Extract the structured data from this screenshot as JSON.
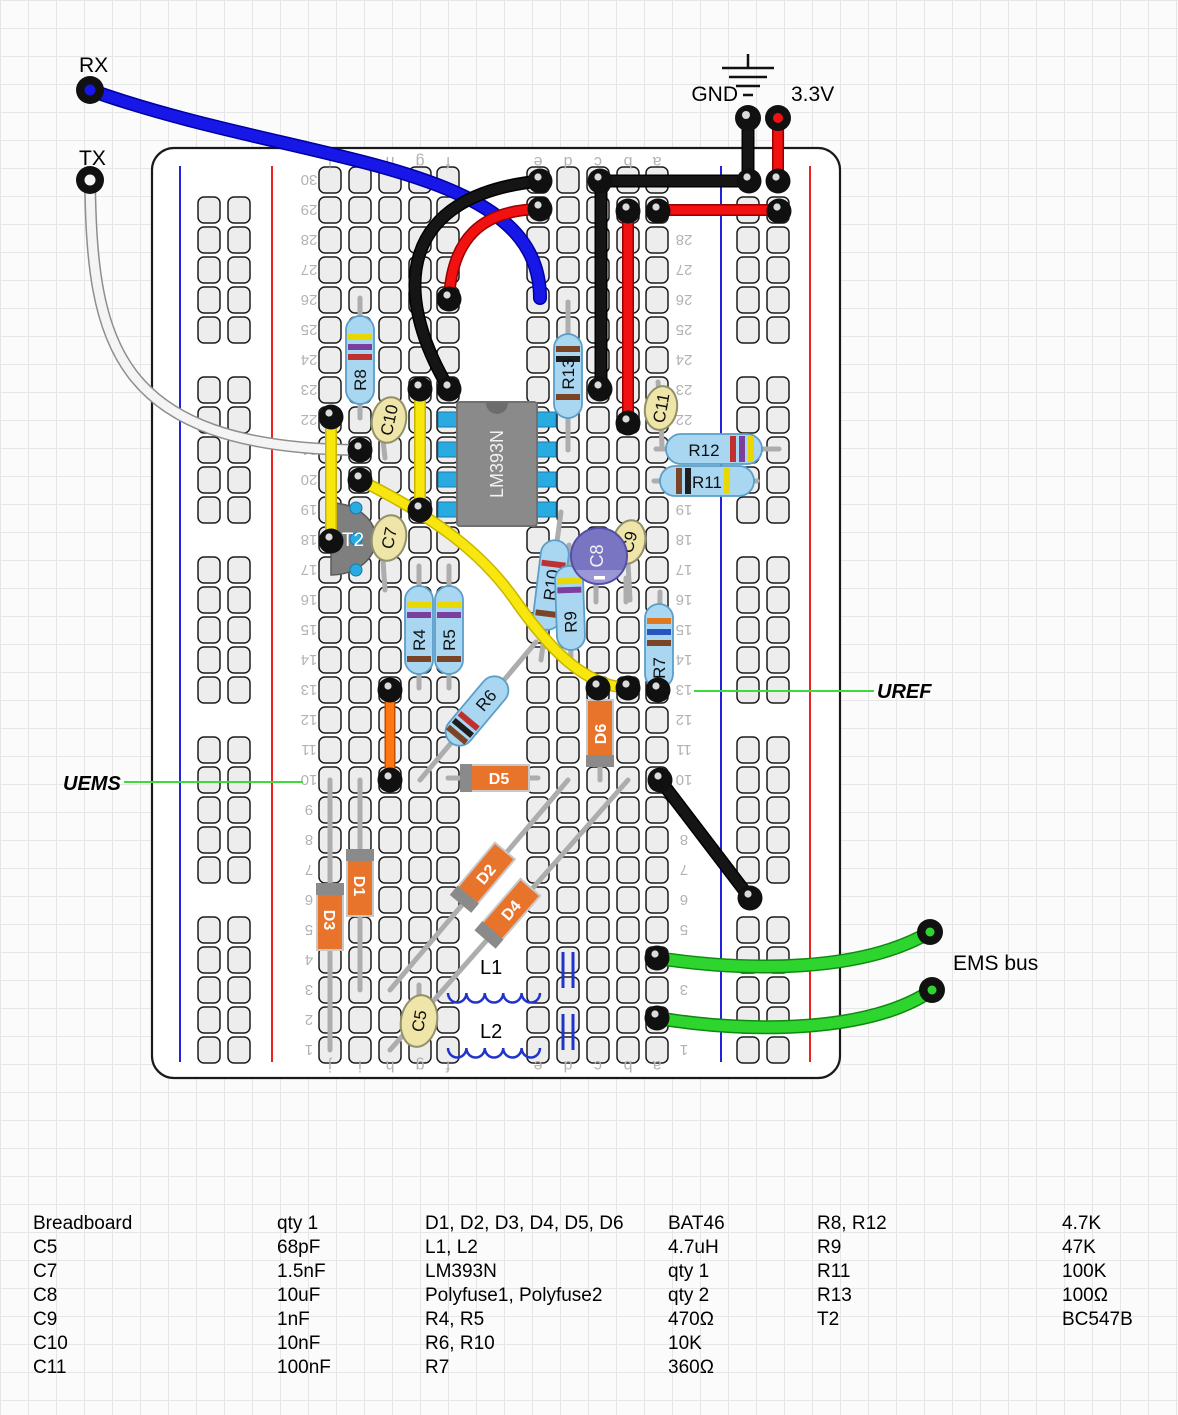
{
  "labels": {
    "rx": "RX",
    "tx": "TX",
    "gnd": "GND",
    "v33": "3.3V",
    "uref": "UREF",
    "uems": "UEMS",
    "ems_bus": "EMS bus"
  },
  "board": {
    "column_letters": [
      "j",
      "i",
      "h",
      "g",
      "f",
      "e",
      "d",
      "c",
      "b",
      "a"
    ],
    "row_count": 30
  },
  "components": {
    "r4": "R4",
    "r5": "R5",
    "r6": "R6",
    "r7": "R7",
    "r8": "R8",
    "r9": "R9",
    "r10": "R10",
    "r11": "R11",
    "r12": "R12",
    "r13": "R13",
    "c5": "C5",
    "c7": "C7",
    "c8": "C8",
    "c9": "C9",
    "c10": "C10",
    "c11": "C11",
    "d1": "D1",
    "d2": "D2",
    "d3": "D3",
    "d4": "D4",
    "d5": "D5",
    "d6": "D6",
    "l1": "L1",
    "l2": "L2",
    "t2": "T2",
    "ic": "LM393N"
  },
  "parts_list": {
    "col1": [
      {
        "n": "Breadboard",
        "v": "qty 1"
      },
      {
        "n": "C5",
        "v": "68pF"
      },
      {
        "n": "C7",
        "v": "1.5nF"
      },
      {
        "n": "C8",
        "v": "10uF"
      },
      {
        "n": "C9",
        "v": "1nF"
      },
      {
        "n": "C10",
        "v": "10nF"
      },
      {
        "n": "C11",
        "v": "100nF"
      }
    ],
    "col2": [
      {
        "n": "D1, D2, D3, D4, D5, D6",
        "v": "BAT46"
      },
      {
        "n": "L1, L2",
        "v": "4.7uH"
      },
      {
        "n": "LM393N",
        "v": "qty 1"
      },
      {
        "n": "Polyfuse1, Polyfuse2",
        "v": "qty 2"
      },
      {
        "n": "R4, R5",
        "v": "470Ω"
      },
      {
        "n": "R6, R10",
        "v": "10K"
      },
      {
        "n": "R7",
        "v": "360Ω"
      }
    ],
    "col3": [
      {
        "n": "R8, R12",
        "v": "4.7K"
      },
      {
        "n": "R9",
        "v": "47K"
      },
      {
        "n": "R11",
        "v": "100K"
      },
      {
        "n": "R13",
        "v": "100Ω"
      },
      {
        "n": "T2",
        "v": "BC547B"
      }
    ]
  },
  "colors": {
    "wire_blue": "#1717E8",
    "wire_red": "#F21111",
    "wire_black": "#151515",
    "wire_white": "#F4F4F4",
    "wire_yellow": "#F7E70F",
    "wire_green": "#2FD52F",
    "wire_orange": "#FF7711",
    "pointer_green": "#3ADB3A",
    "resistor_body": "#A9D7F2",
    "diode_body": "#E8742B",
    "cap_body": "#EFE5A9",
    "electrolytic_body": "#7A75C3",
    "ic_body": "#8A8A8A",
    "pin_blue": "#29ABE2",
    "rail_red": "#EE2222",
    "rail_blue": "#2222DD"
  }
}
